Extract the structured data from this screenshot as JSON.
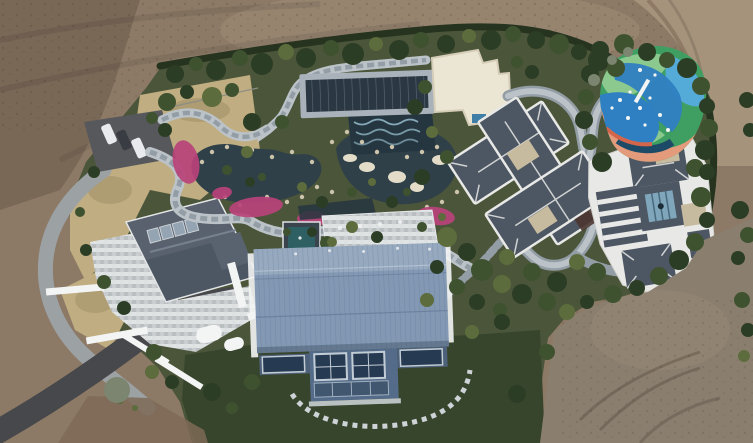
{
  "meta": {
    "type": "aerial drone photograph",
    "subject": "Overhead view of a landscaped hillside estate: ornamental garden with ponds and stone paths, pink azalea beds, a dark pergola canopy, a white flat-roof pavilion, two slate-roof villas, a colorful painted playground, a large blue metal-roof barn house, a stone-patio house with driveway, parking with three cars, all surrounded by bare tilled dirt",
    "width_px": 753,
    "height_px": 443
  },
  "scene": {
    "features": [
      "tilled-dirt-field",
      "hedge-boundary",
      "parking-pad",
      "three-cars",
      "dry-ornamental-grass",
      "pond-garden",
      "stone-paths",
      "azalea-beds",
      "pergola-canopy",
      "white-flat-roof-pavilion",
      "villa-center",
      "villa-east",
      "painted-playground",
      "blue-barn-house",
      "patio-house",
      "asphalt-driveway",
      "stepping-stone-arc",
      "lawn",
      "graded-dirt-southeast"
    ],
    "car_count": 3
  },
  "palette": {
    "dirt_top": "#8c7a66",
    "dirt_dark": "#6b594a",
    "dirt_light": "#a6937c",
    "dirt_gray": "#8a7e6f",
    "dirt_red": "#7e6a57",
    "hedge": "#26331f",
    "tree_dark": "#2c3d25",
    "tree_mid": "#3f5230",
    "tree_olive": "#5d6c3c",
    "tree_gray": "#7c8570",
    "garden_green": "#4b553a",
    "lawn": "#38452d",
    "dry_grass": "#c0ae82",
    "dry_dark": "#9c8a63",
    "pond": "#2f4049",
    "pond_deep": "#263640",
    "water_line": "#9ec7d6",
    "rock": "#cdc4ac",
    "rock_light": "#e3dcc8",
    "flower": "#b9437a",
    "path_light": "#bcc3c8",
    "path_mid": "#939da5",
    "road_dark": "#47484b",
    "drive_light": "#9ca1a4",
    "parking": "#57585b",
    "car_white": "#e8eaed",
    "car_dark": "#393d43",
    "pergola_dark": "#2b3743",
    "pergola_frame": "#a9b2ba",
    "court": "#ebe5d3",
    "court_edge": "#d5cdb7",
    "pool_blue": "#3f7ea6",
    "roof_slate": "#4d5663",
    "roof_trim": "#e8e9e6",
    "roof_tan": "#c7bb9f",
    "glass": "#7fa6ba",
    "deck_brown": "#4b3530",
    "barn": "#8398b3",
    "barn_light": "#a9bacc",
    "barn_wall": "#546c8a",
    "win_dark": "#263a52",
    "win_frame": "#c2ccd5",
    "pavilion_teal": "#2d5f63",
    "terrace": "#d7dadb",
    "play_base": "#3f9e62",
    "play_lgreen": "#8bc98e",
    "play_blue": "#2f80c2",
    "play_cyan": "#55abd8",
    "play_salmon": "#e49b7b",
    "play_coral": "#d2654a",
    "play_navy": "#1d4a66",
    "white": "#f3f4f4"
  }
}
